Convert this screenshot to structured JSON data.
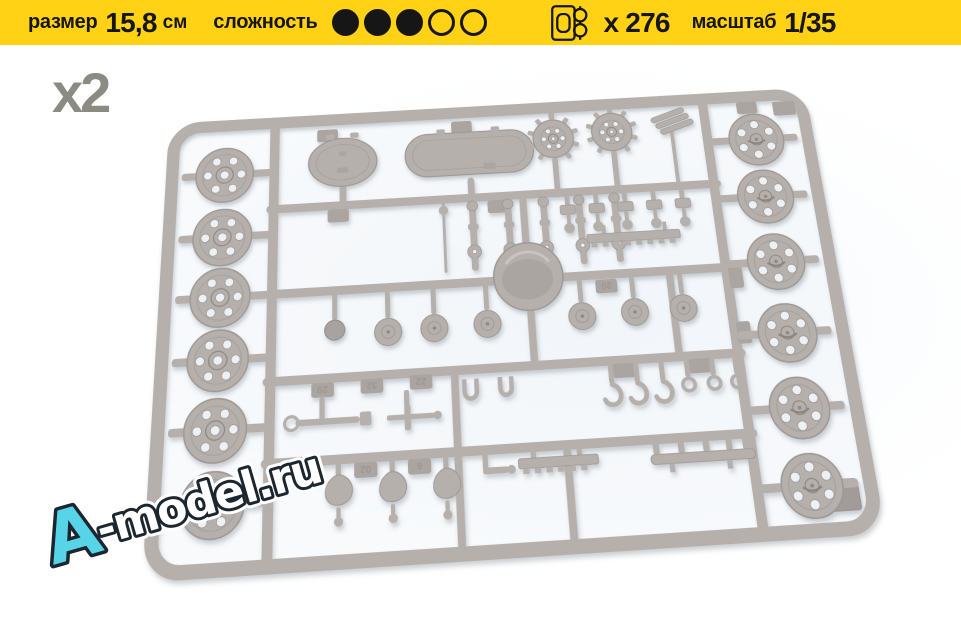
{
  "header": {
    "background_color": "#ffd216",
    "text_color": "#161616",
    "size": {
      "label": "размер",
      "value": "15,8",
      "unit": "см"
    },
    "difficulty": {
      "label": "сложность",
      "filled": 3,
      "total": 5
    },
    "parts": {
      "icon": "sprue-icon",
      "count_label": "x 276"
    },
    "scale": {
      "label": "масштаб",
      "value": "1/35"
    }
  },
  "photo": {
    "quantity_label": "x2",
    "quantity_color": "#8b8b83",
    "plastic_color": "#b6b0ad",
    "part_number_tabs": [
      "29",
      "32",
      "22",
      "02",
      "6",
      "20"
    ]
  },
  "watermark": {
    "prefix": "A",
    "suffix": "-model.ru",
    "prefix_color": "#58d4e8",
    "suffix_color": "#ffffff",
    "outline_color": "#1b262e"
  }
}
